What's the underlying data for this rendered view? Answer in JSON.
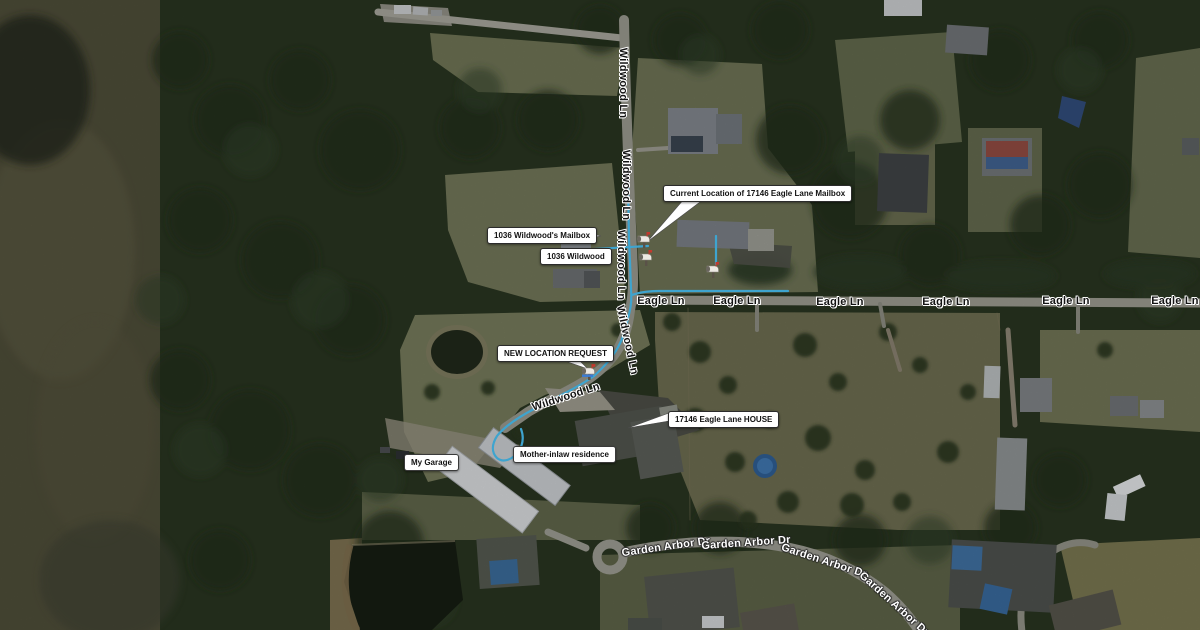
{
  "map": {
    "description": "Aerial satellite view annotated with mailbox relocation request",
    "street_labels": {
      "wildwood_ln": "Wildwood Ln",
      "eagle_ln": "Eagle Ln",
      "garden_arbor_dr": "Garden Arbor Dr"
    },
    "callouts": {
      "current_mailbox": "Current Location of 17146 Eagle Lane Mailbox",
      "wildwoods_mailbox": "1036 Wildwood's Mailbox",
      "wildwood_house": "1036 Wildwood",
      "new_location": "NEW LOCATION REQUEST",
      "eagle_house": "17146 Eagle Lane HOUSE",
      "mother_inlaw": "Mother-inlaw residence",
      "my_garage": "My Garage"
    },
    "icons": {
      "mailbox": "mailbox-icon"
    },
    "colors": {
      "route_line": "#49c0f2",
      "callout_bg": "#ffffff",
      "callout_border": "#2b2b2b",
      "road_label_dark": "#141414",
      "road_label_light": "#ffffff",
      "road": "#98978d"
    }
  }
}
